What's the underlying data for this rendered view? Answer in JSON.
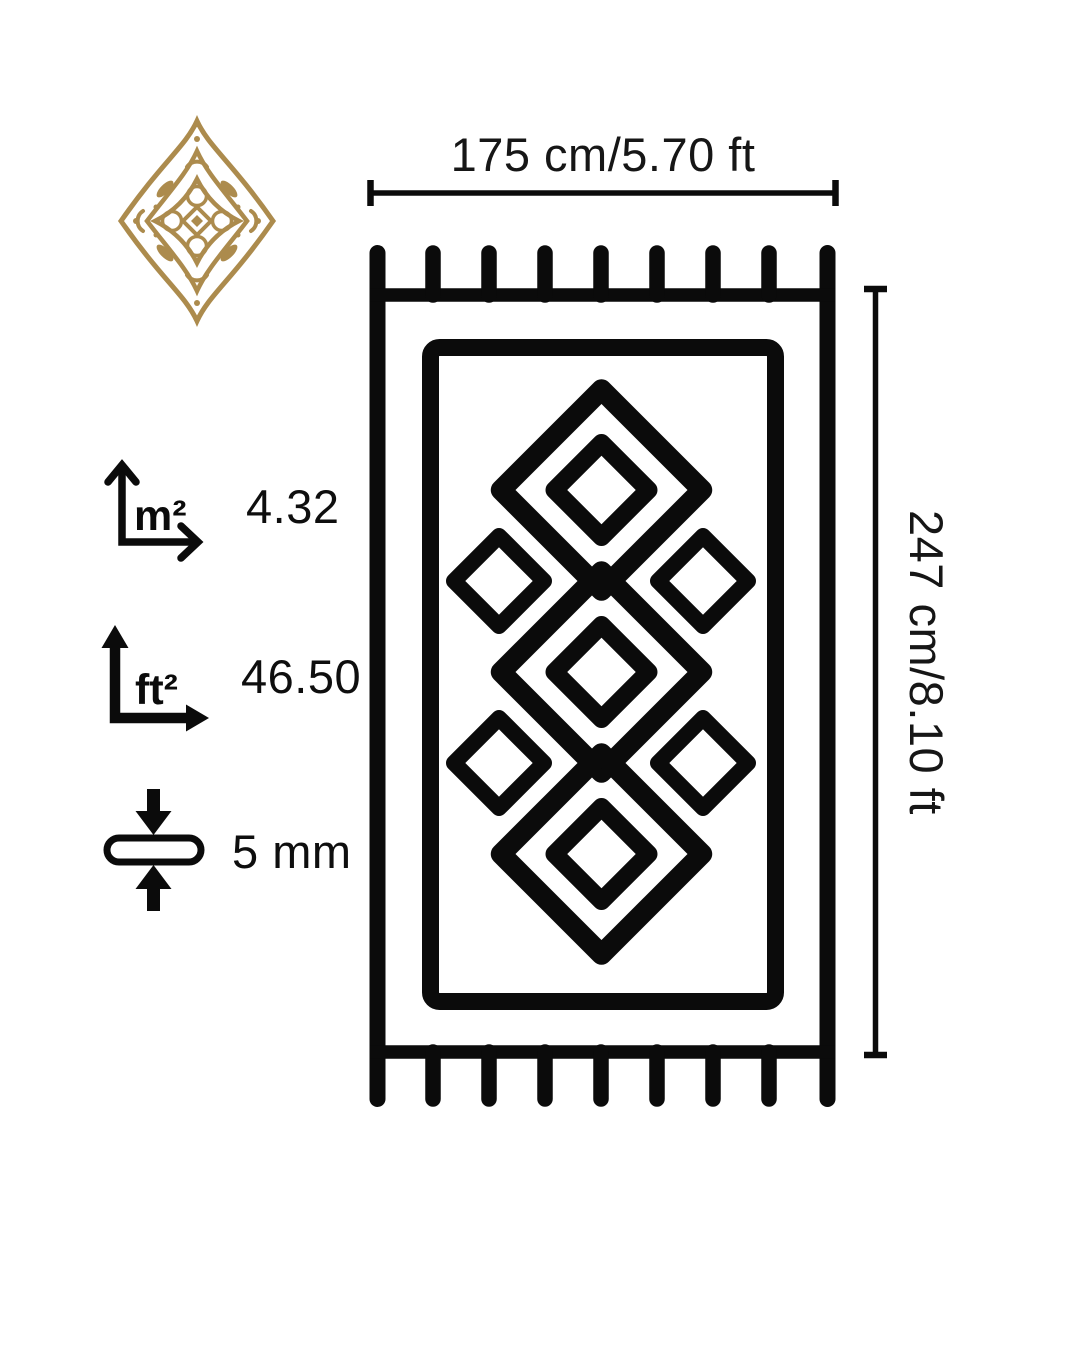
{
  "page": {
    "type": "rug-product-dimension-diagram",
    "background": "#ffffff"
  },
  "colors": {
    "ink": "#0b0b0b",
    "text": "#161616",
    "ornament_gold": "#ac8b4d"
  },
  "ornament": {
    "icon": "arabesque-medallion-icon"
  },
  "dimensions": {
    "width": {
      "label": "175 cm/5.70 ft"
    },
    "height": {
      "label": "247 cm/8.10 ft"
    }
  },
  "specs": [
    {
      "icon": "area-m2-icon",
      "unit": "m²",
      "value": "4.32"
    },
    {
      "icon": "area-ft2-icon",
      "unit": "ft²",
      "value": "46.50"
    },
    {
      "icon": "thickness-icon",
      "unit": "",
      "value": "5 mm"
    }
  ],
  "rug": {
    "icon": "rug-diagram-icon",
    "pattern": "diamond-kilim",
    "fringe_tassels_per_side": 9
  }
}
